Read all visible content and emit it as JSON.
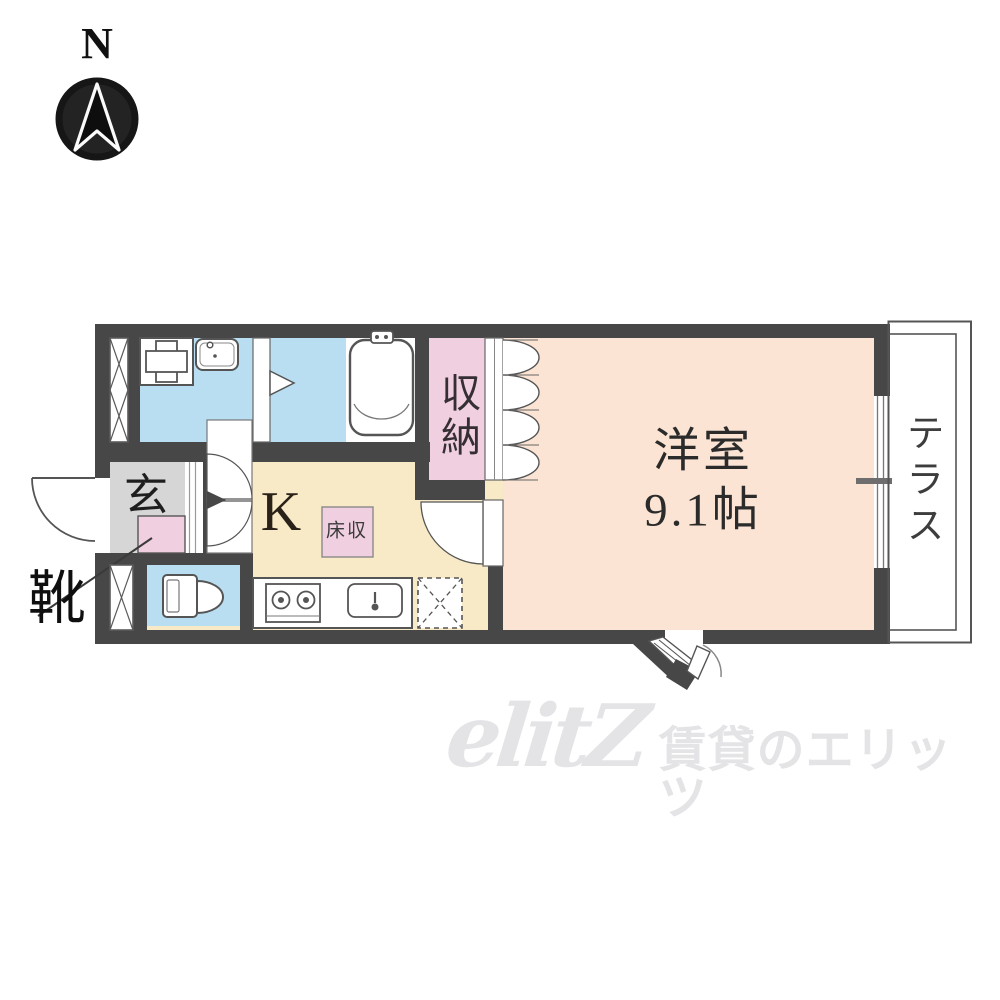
{
  "compass": {
    "label": "N"
  },
  "plan": {
    "rooms": {
      "entrance": {
        "label": "玄"
      },
      "shoe_callout": {
        "label": "靴"
      },
      "kitchen": {
        "label": "K"
      },
      "floor_storage": {
        "label": "床収"
      },
      "closet": {
        "label": "収納"
      },
      "western_room": {
        "name": "洋室",
        "size": "9.1帖"
      },
      "terrace": {
        "label": "テラス"
      }
    }
  },
  "watermark": {
    "logo": "elitZ",
    "brand": "賃貸のエリッツ"
  },
  "colors": {
    "wall": "#474747",
    "wet_room_blue": "#b9def2",
    "kitchen_cream": "#f8eac6",
    "western_room_peach": "#fbe4d3",
    "closet_pink": "#f0cfe1",
    "entrance_gray": "#d6d6d6",
    "line_gray": "#555555",
    "watermark_gray": "#e4e4e7"
  }
}
